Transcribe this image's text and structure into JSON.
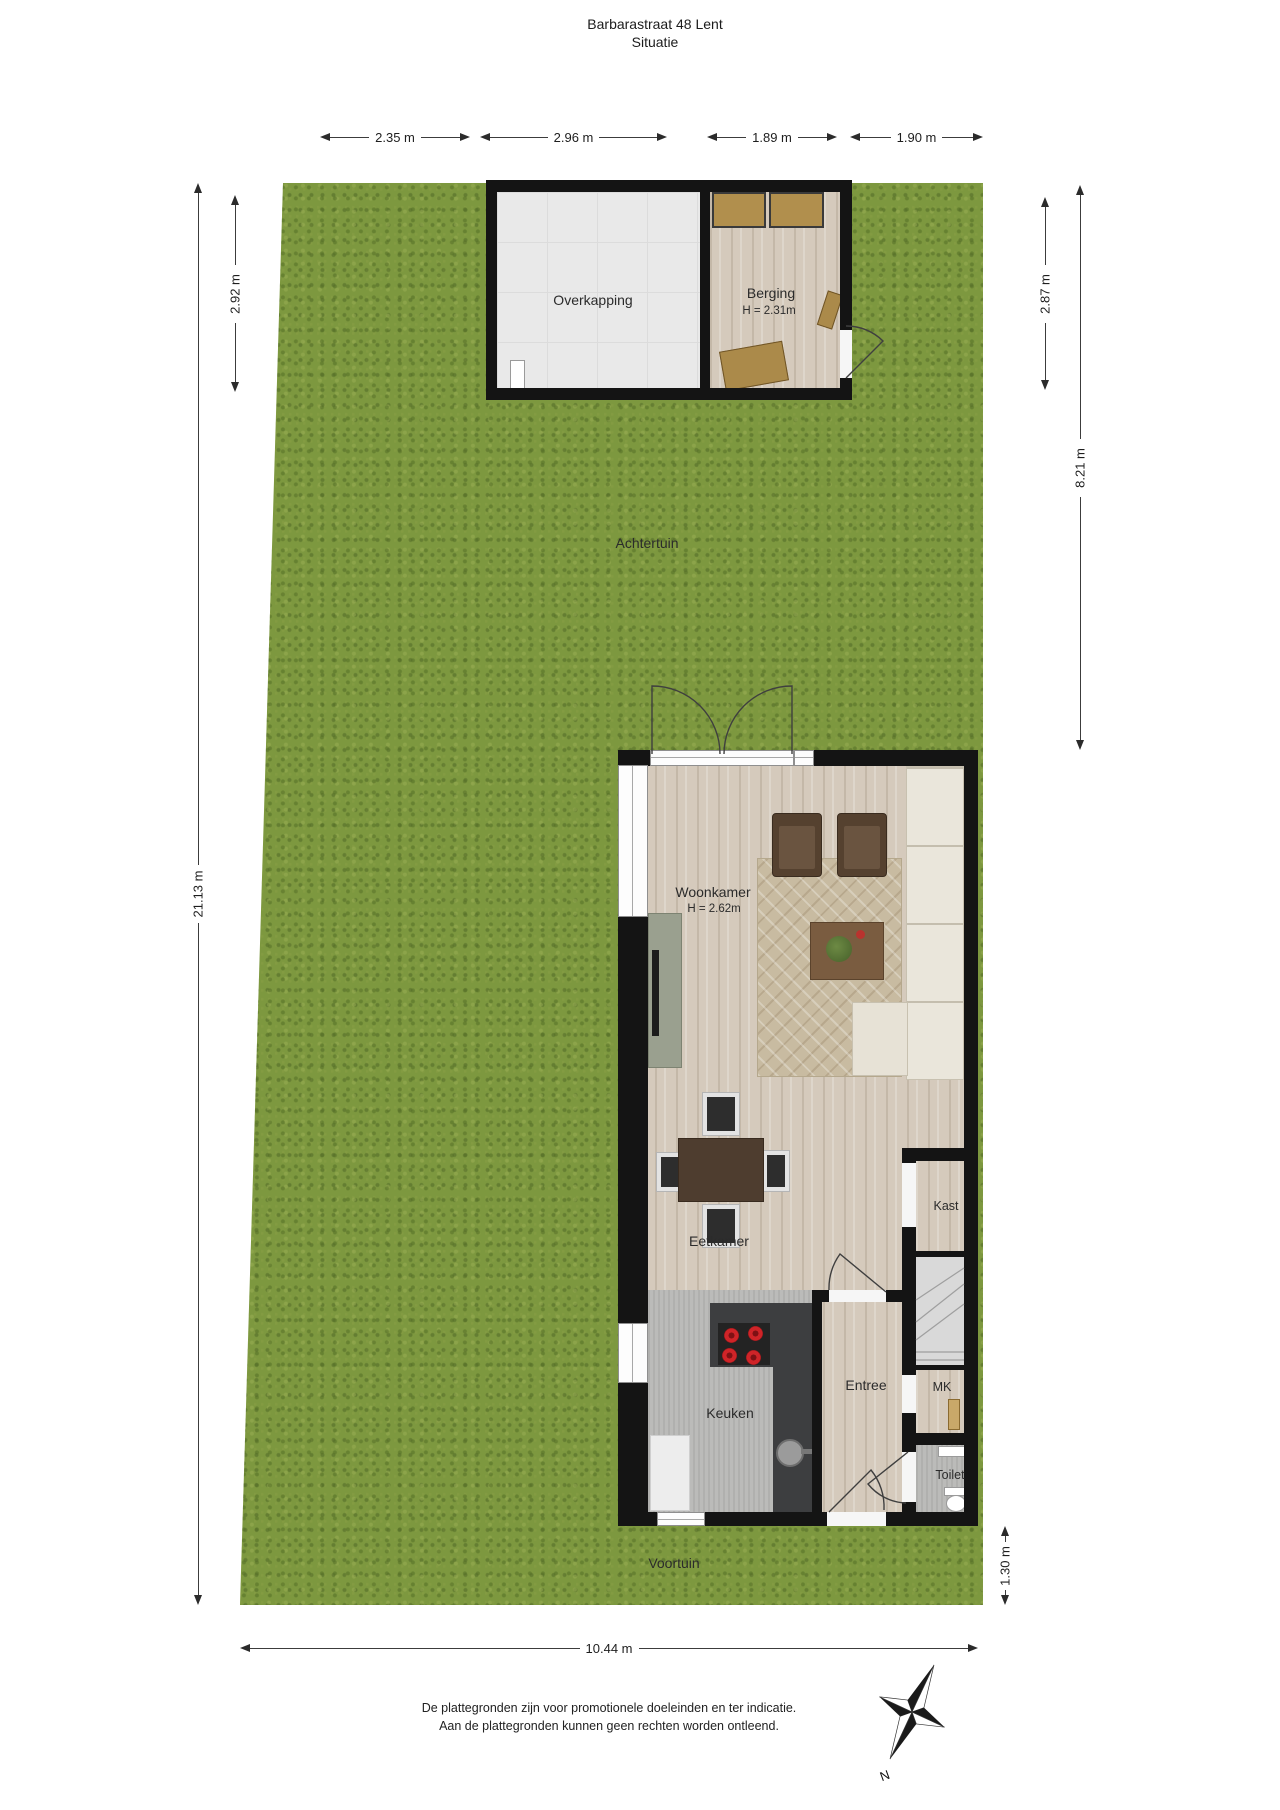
{
  "title": {
    "line1": "Barbarastraat 48 Lent",
    "line2": "Situatie"
  },
  "labels": {
    "overkapping": "Overkapping",
    "berging": "Berging",
    "berging_height": "H = 2.31m",
    "achtertuin": "Achtertuin",
    "woonkamer": "Woonkamer",
    "woonkamer_height": "H = 2.62m",
    "eetkamer": "Eetkamer",
    "keuken": "Keuken",
    "entree": "Entree",
    "kast": "Kast",
    "mk": "MK",
    "toilet": "Toilet",
    "voortuin": "Voortuin"
  },
  "dimensions": {
    "top_garden_left": "2.35 m",
    "top_overkapping": "2.96 m",
    "top_berging": "1.89 m",
    "top_garden_right": "1.90 m",
    "left_total": "21.13 m",
    "left_overkapping_depth": "2.92 m",
    "right_berging_depth": "2.87 m",
    "right_garden_depth": "8.21 m",
    "right_voortuin_depth": "1.30 m",
    "bottom_total": "10.44 m"
  },
  "compass": {
    "north": "N"
  },
  "footer": {
    "line1": "De plattegronden zijn voor promotionele doeleinden en ter indicatie.",
    "line2": "Aan de plattegronden kunnen geen rechten worden ontleend."
  },
  "colors": {
    "grass": "#7d983f",
    "wall": "#141414",
    "wood_floor": "#d5cabc",
    "overkapping_tiles": "#e9e9e9",
    "kitchen_floor": "#bbbbb9",
    "counter": "#3d3e40",
    "burner_red": "#cf2428",
    "sofa": "#eae6db",
    "rug": "#c8bba1",
    "stairs": "#d9d9d9"
  }
}
